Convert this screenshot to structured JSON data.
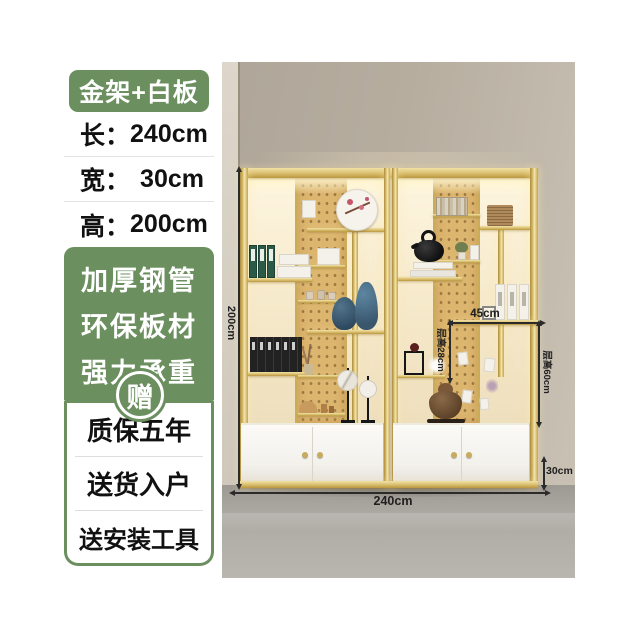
{
  "sidebar": {
    "badge": "金架+白板",
    "specs": [
      {
        "label": "长：",
        "value": "240cm"
      },
      {
        "label": "宽：",
        "value": "30cm"
      },
      {
        "label": "高：",
        "value": "200cm"
      }
    ],
    "features": [
      "加厚钢管",
      "环保板材",
      "强力承重"
    ],
    "gift": "赠",
    "services": [
      "质保五年",
      "送货入户",
      "送安装工具"
    ]
  },
  "photo": {
    "annotations": {
      "total_height": "200cm",
      "total_width": "240cm",
      "shelf_width_mid": "45cm",
      "layer_height_small": "层高28cm",
      "layer_height_large": "层高60cm",
      "cabinet_height": "30cm"
    }
  },
  "colors": {
    "accent_green": "#6b8f5e",
    "frame_gold": "#d9bd6d",
    "pegboard_tan": "#dcb56e"
  }
}
